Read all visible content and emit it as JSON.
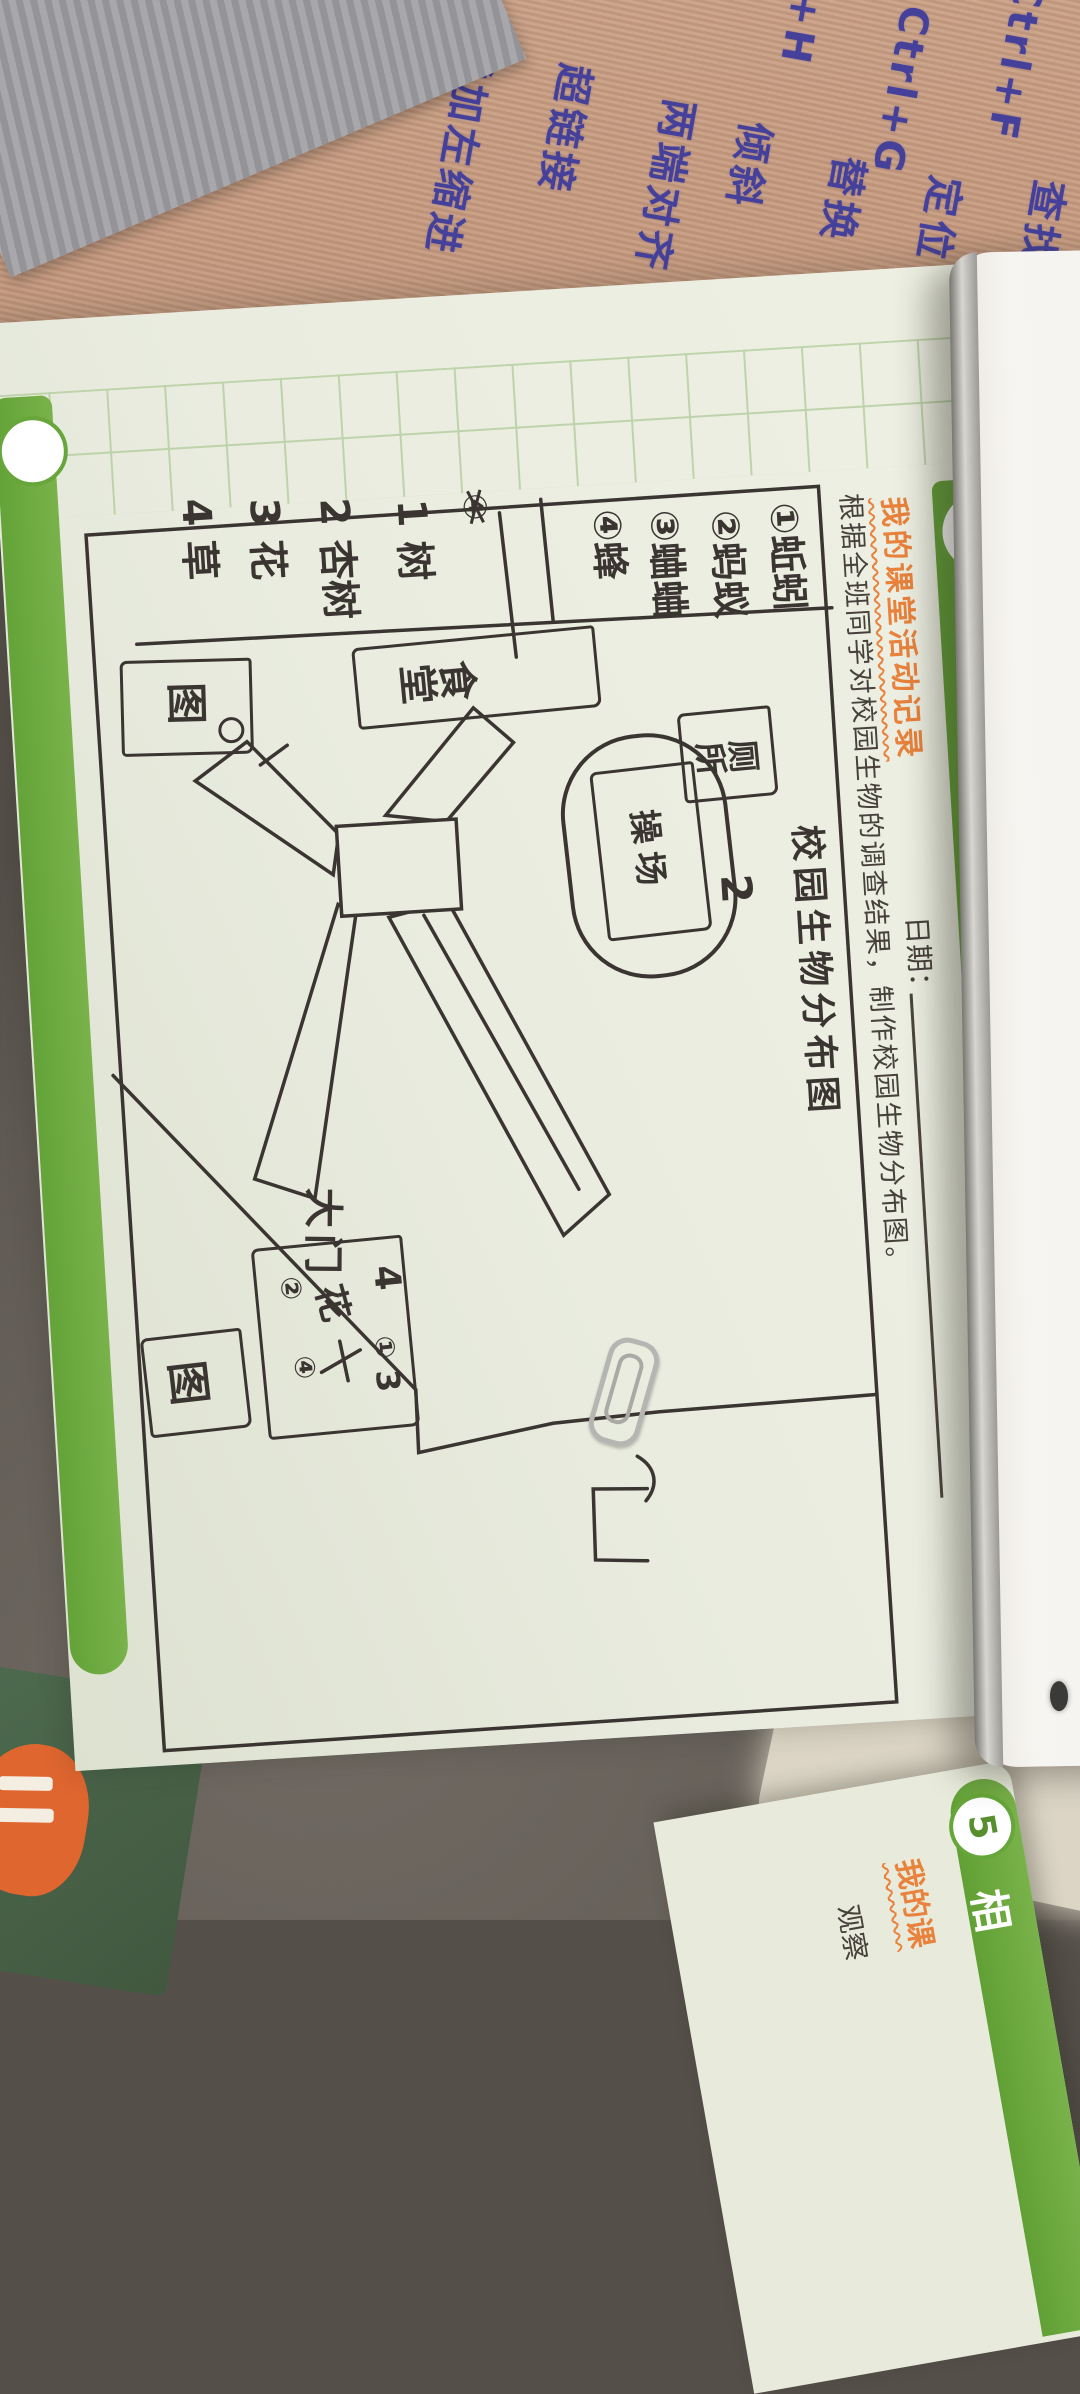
{
  "desk_mat": {
    "shortcuts": [
      {
        "keys": "Ctrl+F",
        "label": "查找"
      },
      {
        "keys": "Ctrl+G",
        "label": "定位"
      },
      {
        "keys": "Ctrl+H",
        "label": "替换"
      }
    ],
    "format_labels": [
      "倾斜",
      "两端对齐",
      "超链接",
      "增加左缩进",
      "新建"
    ]
  },
  "page": {
    "badge": "2",
    "title": "制作校园生物分布图",
    "subtitle": "我的课堂活动记录",
    "date_label": "日期：",
    "instruction": "根据全班同学对校园生物的调查结果，制作校园生物分布图。",
    "map": {
      "title": "校园生物分布图",
      "insects": [
        "①蚯蚓",
        "②蚂蚁",
        "③蛐蛐",
        "④蜂"
      ],
      "scribble": "④",
      "plants": [
        "1 树",
        "2 杏树",
        "3 花",
        "4 草"
      ],
      "canteen": "食堂",
      "toilet": "厕所",
      "playground": "操场",
      "playground_mark": "2",
      "gate": "大门",
      "box_label_1": "图",
      "box_label_2": "图",
      "flowerbed": {
        "n4": "4",
        "c1": "①",
        "n3": "3",
        "flower": "花",
        "c2": "②",
        "c4": "④"
      }
    }
  },
  "facing_page": {
    "badge": "5",
    "title_partial": "相",
    "subtitle_partial": "我的课",
    "body_partial": "观察"
  }
}
